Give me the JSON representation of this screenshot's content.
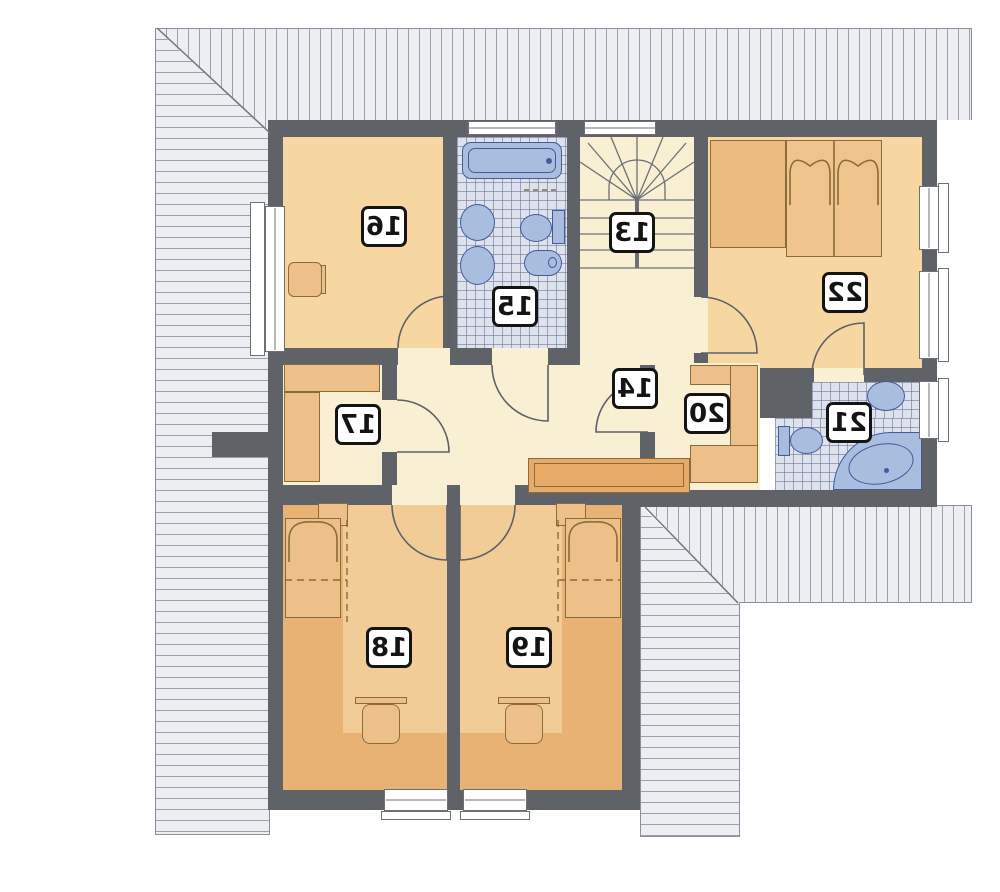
{
  "plan": {
    "kind": "attic-floor-plan-mirrored",
    "rooms": {
      "r13": {
        "label": "13"
      },
      "r14": {
        "label": "14"
      },
      "r15": {
        "label": "15"
      },
      "r16": {
        "label": "16"
      },
      "r17": {
        "label": "17"
      },
      "r18": {
        "label": "18"
      },
      "r19": {
        "label": "19"
      },
      "r20": {
        "label": "20"
      },
      "r21": {
        "label": "21"
      },
      "r22": {
        "label": "22"
      }
    },
    "palette": {
      "wall": "#5f6267",
      "floor_orange": "#f6d7a2",
      "floor_orange_dark": "#e9b275",
      "floor_cream": "#f9f0d3",
      "tile_background": "#dde2ed",
      "fixture_blue": "#a9bedf",
      "fixture_outline": "#46599b",
      "furniture": "#eec089",
      "furniture_outline": "#8a6b3a",
      "roof_hatch": "#eceef1",
      "label_border": "#141414"
    }
  }
}
